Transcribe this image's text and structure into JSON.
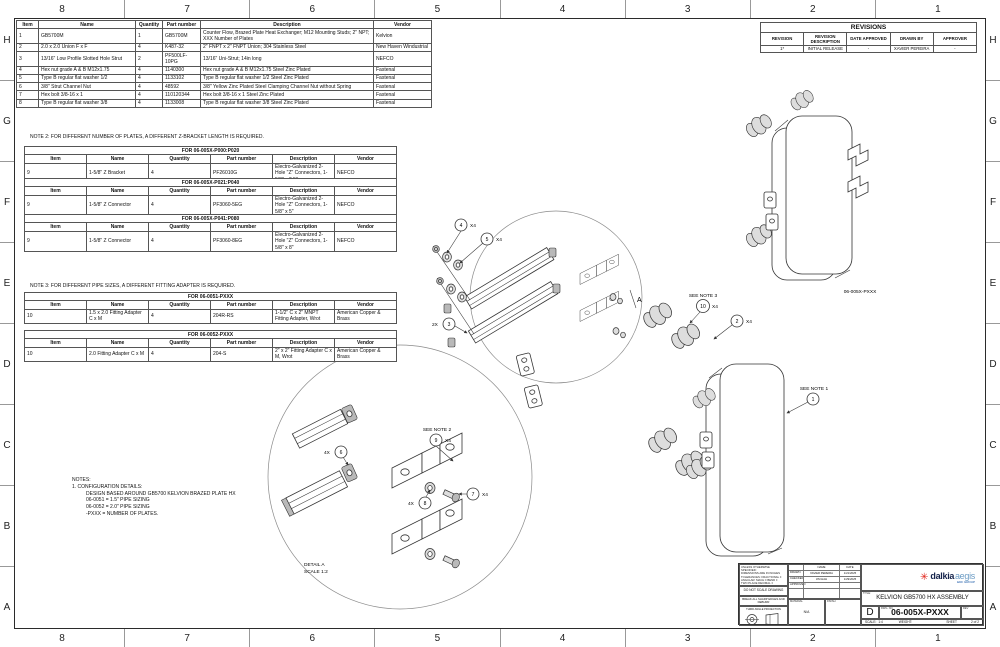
{
  "border": {
    "columns": [
      "8",
      "7",
      "6",
      "5",
      "4",
      "3",
      "2",
      "1"
    ],
    "rows": [
      "H",
      "G",
      "F",
      "E",
      "D",
      "C",
      "B",
      "A"
    ]
  },
  "bom_main": {
    "headers": [
      "Item",
      "Name",
      "Quantity",
      "Part number",
      "Description",
      "Vendor"
    ],
    "rows": [
      [
        "1",
        "GB5700M",
        "1",
        "GB5700M",
        "Counter Flow, Brazed Plate Heat Exchanger; M12 Mounting Studs; 2\" NPT; XXX Number of Plates",
        "Kelvion"
      ],
      [
        "2",
        "2.0 x 2.0 Union F x F",
        "4",
        "K487-32",
        "2\" FNPT x 2\" FNPT Union; 304 Stainless Steel",
        "New Haven Windustrial"
      ],
      [
        "3",
        "13/16\" Low Profile Slotted Hole Strut",
        "2",
        "PF500LF-10PG",
        "13/16\" Uni-Strut; 14in long",
        "NEFCO"
      ],
      [
        "4",
        "Hex nut grade A & B M12x1.75",
        "4",
        "1140300",
        "Hex nut grade A & B M12x1.75 Steel Zinc Plated",
        "Fastenal"
      ],
      [
        "5",
        "Type B regular flat washer 1/2",
        "4",
        "1133102",
        "Type B regular flat washer 1/2 Steel Zinc Plated",
        "Fastenal"
      ],
      [
        "6",
        "3/8\" Strut Channel Nut",
        "4",
        "48592",
        "3/8\" Yellow Zinc Plated Steel Clamping Channel Nut without Spring",
        "Fastenal"
      ],
      [
        "7",
        "Hex bolt 3/8-16 x 1",
        "4",
        "110120344",
        "Hex bolt 3/8-16 x 1 Steel Zinc Plated",
        "Fastenal"
      ],
      [
        "8",
        "Type B regular flat washer 3/8",
        "4",
        "1133008",
        "Type B regular flat washer 3/8 Steel Zinc Plated",
        "Fastenal"
      ]
    ]
  },
  "note2": "NOTE 2: FOR DIFFERENT NUMBER OF PLATES, A DIFFERENT Z-BRACKET LENGTH IS REQUIRED.",
  "note3": "NOTE 3: FOR DIFFERENT PIPE SIZES, A DIFFERENT FITTING ADAPTER IS REQUIRED.",
  "sub_table_1": {
    "title": "FOR 06-005X-P000:P020",
    "headers": [
      "Item",
      "Name",
      "Quantity",
      "Part number",
      "Description",
      "Vendor"
    ],
    "rows": [
      [
        "9",
        "1-5/8\" Z Bracket",
        "4",
        "PF26010G",
        "Electro-Galvanized 2-Hole \"Z\" Connectors, 1-5/8\" x 2.5\"",
        "NEFCO"
      ]
    ]
  },
  "sub_table_2": {
    "title": "FOR 06-005X-P021:P040",
    "headers": [
      "Item",
      "Name",
      "Quantity",
      "Part number",
      "Description",
      "Vendor"
    ],
    "rows": [
      [
        "9",
        "1-5/8\" Z Connector",
        "4",
        "PF3060-5EG",
        "Electro-Galvanized 2-Hole \"Z\" Connectors, 1-5/8\" x 5\"",
        "NEFCO"
      ]
    ]
  },
  "sub_table_3": {
    "title": "FOR 06-005X-P041:P080",
    "headers": [
      "Item",
      "Name",
      "Quantity",
      "Part number",
      "Description",
      "Vendor"
    ],
    "rows": [
      [
        "9",
        "1-5/8\" Z Connector",
        "4",
        "PF3060-8EG",
        "Electro-Galvanized 2-Hole \"Z\" Connectors, 1-5/8\" x 8\"",
        "NEFCO"
      ]
    ]
  },
  "fitting_table_1": {
    "title": "FOR 06-0051-PXXX",
    "headers": [
      "Item",
      "Name",
      "Quantity",
      "Part number",
      "Description",
      "Vendor"
    ],
    "rows": [
      [
        "10",
        "1.5 x 2.0 Fitting Adapter C x M",
        "4",
        "204R-RS",
        "1-1/2\" C x 2\" MNPT Fitting Adapter, Wrot",
        "American Copper & Brass"
      ]
    ]
  },
  "fitting_table_2": {
    "title": "FOR 06-0052-PXXX",
    "headers": [
      "Item",
      "Name",
      "Quantity",
      "Part number",
      "Description",
      "Vendor"
    ],
    "rows": [
      [
        "10",
        "2.0 Fitting Adapter C x M",
        "4",
        "204-S",
        "2\" x 2\" Fitting Adapter C x M, Wrot",
        "American Copper & Brass"
      ]
    ]
  },
  "revisions": {
    "title": "REVISIONS",
    "headers": [
      "REVISION",
      "REVISION DESCRIPTION",
      "DATE APPROVED",
      "DRAWN BY",
      "APPROVER"
    ],
    "rows": [
      [
        "1*",
        "INITIAL RELEASE",
        "-",
        "XAVIER PEREIRA",
        "-"
      ]
    ]
  },
  "notes": {
    "l1": "NOTES:",
    "l2": "1. CONFIGURATION DETAILS:",
    "l3": "DESIGN BASED AROUND GB5700 KELVION BRAZED PLATE HX",
    "l4": "06-0051 = 1.5\" PIPE SIZING",
    "l5": "06-0052 = 2.0\" PIPE SIZING",
    "l6": "-PXXX = NUMBER OF PLATES."
  },
  "drawing": {
    "assembly_pn": "06-005X-PXXX",
    "see_note_1": "SEE NOTE 1",
    "see_note_2": "SEE NOTE 2",
    "see_note_3": "SEE NOTE 3",
    "detail_title": "DETAIL A",
    "detail_scale": "SCALE 1:2",
    "section_label": "A",
    "balloons": {
      "b1": "1",
      "b2": "2",
      "b3": "3",
      "b4": "4",
      "b5": "5",
      "b6": "6",
      "b7": "7",
      "b8": "8",
      "b9": "9",
      "b10": "10"
    },
    "qty": {
      "x4": "X4",
      "p2x": "2X",
      "p4x": "4X"
    }
  },
  "title_block": {
    "spec": {
      "u1": "UNLESS OTHERWISE SPECIFIED:",
      "u2": "DIMENSIONS ARE IN INCHES",
      "u3": "TOLERANCES: FRACTIONAL ±",
      "u4": "ANGULAR: MACH ±  BEND ±",
      "u5": "TWO PLACE DECIMAL ±",
      "u6": "SURFACE FINISH"
    },
    "do_not_scale": "DO NOT SCALE DRAWING",
    "deburr": "BREAK ALL SHARP EDGES AND DEBURR",
    "projection": "THIRD ANGLE PROJECTION",
    "cols": {
      "name": "NAME",
      "date": "DATE"
    },
    "sign_rows": {
      "drawn_label": "DRAWN",
      "drawn_name": "XAVIER PEREIRA",
      "drawn_date": "1/21/2025",
      "checked_label": "CHECKED",
      "checked_name": "JIM HAH",
      "checked_date": "1/29/2025",
      "approved_label": "APPROVED",
      "approved_name": "",
      "approved_date": ""
    },
    "material_label": "MATERIAL",
    "material_value": "N/A",
    "finish_label": "FINISH",
    "logo": {
      "star": "✳",
      "dalkia": "dalkia",
      "aegis": "aegis",
      "edf": "EDF GROUP"
    },
    "title_label": "TITLE:",
    "title": "KELVION GB5700 HX ASSEMBLY",
    "size": "D",
    "dwg_label": "DWG. NO.",
    "dwg_no": "06-005X-PXXX",
    "rev_label": "REV",
    "scale_label": "SCALE:",
    "scale": "1:4",
    "weight_label": "WEIGHT:",
    "sheet_label": "SHEET",
    "sheet": "2 of 2"
  }
}
